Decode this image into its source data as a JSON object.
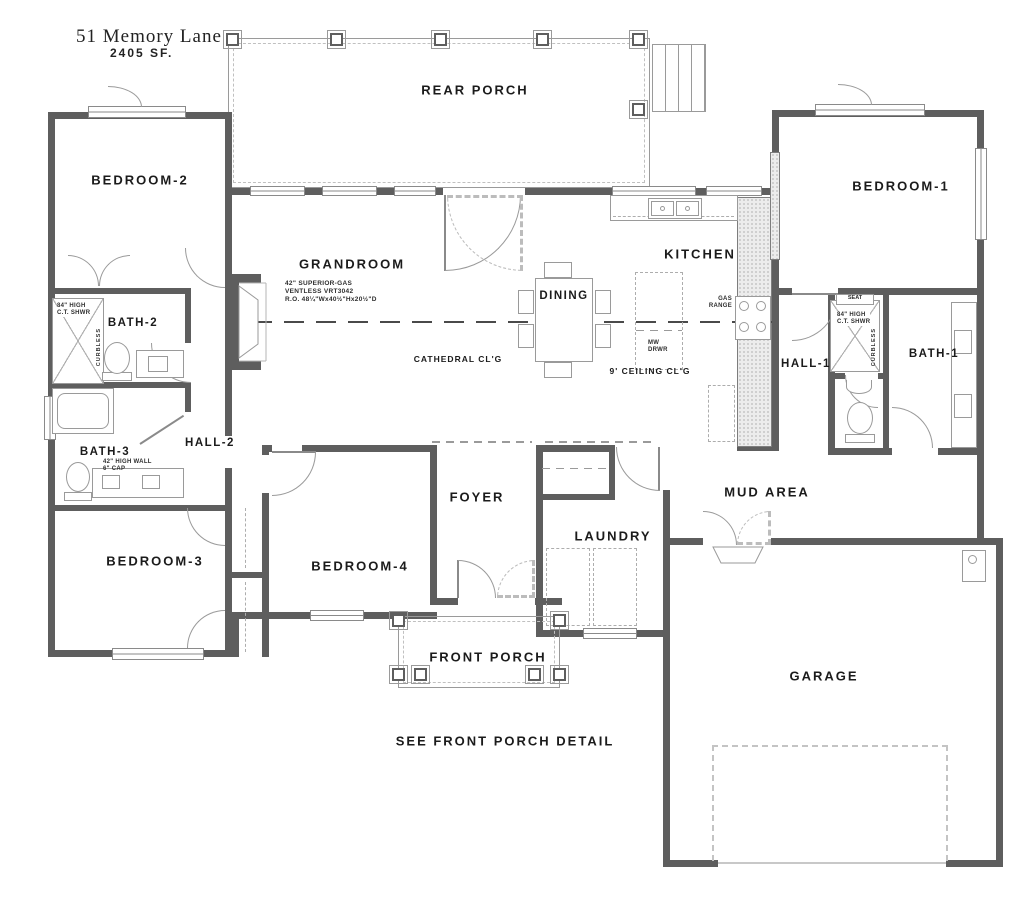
{
  "title": {
    "address": "51 Memory Lane",
    "sqft": "2405 SF."
  },
  "rooms": {
    "rear_porch": "REAR PORCH",
    "bedroom_2": "BEDROOM-2",
    "bedroom_1": "BEDROOM-1",
    "grandroom": "GRANDROOM",
    "kitchen": "KITCHEN",
    "dining": "DINING",
    "bath_2": "BATH-2",
    "bath_3": "BATH-3",
    "bath_1": "BATH-1",
    "hall_1": "HALL-1",
    "hall_2": "HALL-2",
    "foyer": "FOYER",
    "laundry": "LAUNDRY",
    "mud_area": "MUD AREA",
    "bedroom_3": "BEDROOM-3",
    "bedroom_4": "BEDROOM-4",
    "garage": "GARAGE",
    "front_porch": "FRONT PORCH"
  },
  "annotations": {
    "cathedral_ceiling": "CATHEDRAL CL'G",
    "nine_ft_ceiling": "9' CEILING CL'G",
    "see_front_porch_detail": "SEE FRONT PORCH DETAIL",
    "fireplace": [
      "42\" SUPERIOR-GAS",
      "VENTLESS VRT3042",
      "R.O. 48¼\"Wx40½\"Hx20½\"D"
    ],
    "gas_range": [
      "GAS",
      "RANGE"
    ],
    "microwave_drawer": [
      "MW",
      "DRWR"
    ],
    "shower_spec": [
      "84\" HIGH",
      "C.T. SHWR"
    ],
    "curbless": "CURBLESS",
    "seat": "SEAT",
    "bath3_wall": [
      "42\" HIGH WALL",
      "6\" CAP"
    ]
  },
  "colors": {
    "wall": "#5e5e5e",
    "fixture_line": "#9a9a9a",
    "text": "#1b1b1b",
    "background": "#ffffff"
  }
}
